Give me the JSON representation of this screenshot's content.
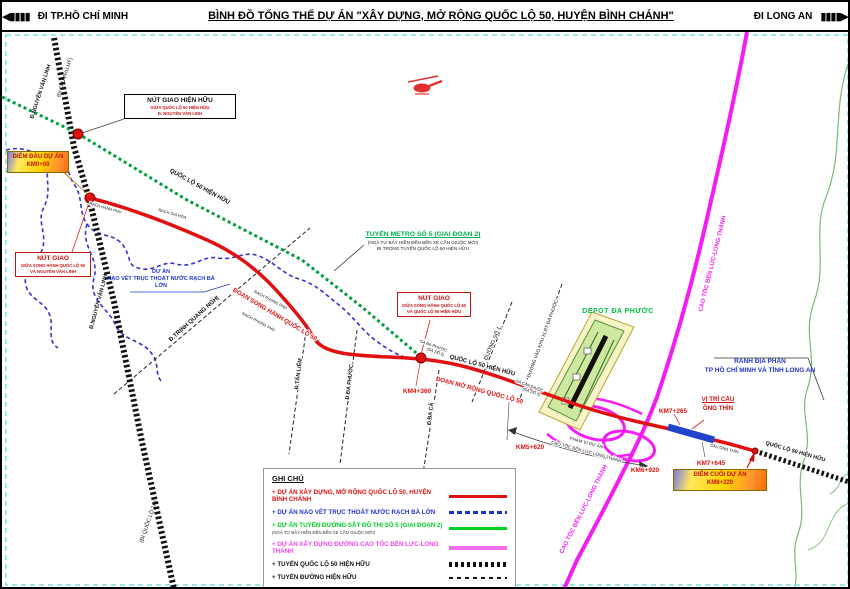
{
  "header": {
    "left_destination": "ĐI TP.HỒ CHÍ MINH",
    "title": "BÌNH ĐỒ TỔNG THỂ DỰ ÁN \"XÂY DỰNG, MỞ RỘNG QUỐC LỘ 50, HUYỆN BÌNH CHÁNH\"",
    "right_destination": "ĐI LONG AN"
  },
  "icons": {
    "arrow_left": "◀",
    "arrow_right": "▶",
    "bars": "▮▮▮▮"
  },
  "colors": {
    "project_red": "#e01010",
    "dredge_blue": "#2233cc",
    "metro_green": "#009f3c",
    "expressway_magenta": "#f31df3",
    "existing_black": "#111111",
    "boundary_green": "#77bb77",
    "callout_yellow": "#ffd400"
  },
  "callouts": {
    "existing_junction": {
      "line1": "NÚT GIAO HIỆN HỮU",
      "line2": "GIỮA QUỐC LỘ 50 HIỆN HỮU",
      "line3": "Đ. NGUYỄN VĂN LINH"
    },
    "start_point": {
      "line1": "ĐIỂM ĐẦU DỰ ÁN",
      "line2": "KM0+00"
    },
    "junction_left": {
      "line1": "NÚT GIAO",
      "line2": "GIỮA SONG HÀNH QUỐC LỘ 50",
      "line3": "VÀ NGUYỄN VĂN LINH"
    },
    "junction_mid": {
      "line1": "NÚT GIAO",
      "line2": "GIỮA SONG HÀNH QUỐC LỘ 50",
      "line3": "VÀ QUỐC LỘ 50 HIỆN HỮU"
    },
    "metro": {
      "line1": "TUYẾN METRO SỐ 5 (GIAI ĐOẠN 2)",
      "line2": "(NGÃ TƯ BẢY HIỀN ĐẾN BẾN XE CẦN GIUỘC MỚI)",
      "line3": "ĐI TRONG TUYẾN QUỐC LỘ 50 HIỆN HỮU"
    },
    "dredge_project": {
      "line1": "DỰ ÁN",
      "line2": "NẠO VÉT TRỤC THOÁT NƯỚC RẠCH BÀ LỚN"
    },
    "depot": "DEPOT ĐA PHƯỚC",
    "boundary": {
      "line1": "RANH ĐỊA PHẬN",
      "line2": "TP HỒ CHÍ MINH VÀ TỈNH LONG AN"
    },
    "bridge_position": {
      "line1": "VỊ TRÍ CẦU",
      "line2": "ÔNG THÌN"
    },
    "end_point": {
      "line1": "ĐIỂM CUỐI DỰ ÁN",
      "line2": "KM8+220"
    },
    "expressway_scope": {
      "line1": "PHẠM VI DỰ ÁN",
      "line2": "CAO TỐC BẾN LỨC LONG THÀNH"
    }
  },
  "km_markers": {
    "km4": "KM4+360",
    "km5": "KM5+620",
    "km6": "KM6+920",
    "km7a": "KM7+265",
    "km7b": "KM7+645"
  },
  "road_labels": {
    "nvl_top": "Đ.NGUYỄN VĂN LINH",
    "nvl_dir_top": "(ĐI CẦU PHÚ MỸ)",
    "nvl_mid": "Đ.NGUYỄN VĂN LINH",
    "nvl_dir_bottom": "(ĐI QUỐC LỘ 1A)",
    "ql50_existing_top": "QUỐC LỘ 50 HIỆN HỮU",
    "ql50_existing_mid": "QUỐC LỘ 50 HIỆN HỮU",
    "ql50_existing_right": "QUỐC LỘ 50 HIỆN HỮU",
    "parallel_section": "ĐOẠN SONG HÀNH QUỐC LỘ 50",
    "widening_section": "ĐOẠN MỞ RỘNG QUỐC LỘ 50",
    "trinh_quang_nghi": "Đ.TRỊNH QUANG NGHỊ",
    "tan_liem": "Đ.TÂN LIÊM",
    "da_phuoc_road": "Đ.ĐA PHƯỚC",
    "ba_ca": "Đ.BA CẢ",
    "duong_so_1": "ĐƯỜNG SỐ 1",
    "waste_road": "ĐƯỜNG VÀO KHU XLRT ĐA PHƯỚC",
    "expressway_top": "CAO TỐC BẾN LỨC-LONG THÀNH",
    "expressway_bottom": "CAO TỐC BẾN LỨC-LONG THÀNH",
    "stream1": "RẠCH HANH PHÚ",
    "stream2": "RẠCH GIA HÒA",
    "stream3": "RẠCH PHONG PHÚ",
    "stream4": "RẠCH PHONG PHÚ",
    "station2a": "GA ĐA PHƯỚC",
    "station2b": "(GA SỐ 2)",
    "station3a": "GA CẦN GIUỘC",
    "station3b": "(GA SỐ 3)",
    "bridge_name": "CẦU ÔNG THÌN"
  },
  "legend": {
    "title": "GHI CHÚ",
    "items": [
      {
        "label": "+ DỰ ÁN XÂY DỰNG, MỞ RỘNG QUỐC LỘ 50, HUYỆN BÌNH CHÁNH"
      },
      {
        "label": "+ DỰ ÁN NẠO VÉT TRỤC THOÁT NƯỚC RẠCH BÀ LỚN"
      },
      {
        "label": "+ DỰ ÁN TUYẾN ĐƯỜNG SẮT ĐÔ THỊ SỐ 5 (GIAI ĐOẠN 2)",
        "sub": "(NGÃ TƯ BẢY HIỀN ĐẾN BẾN XE CẦN GIUỘC MỚI)"
      },
      {
        "label": "+ DỰ ÁN XÂY DỰNG ĐƯỜNG CAO TỐC BẾN LỨC-LONG THÀNH"
      },
      {
        "label": "+ TUYẾN QUỐC LỘ 50 HIỆN HỮU"
      },
      {
        "label": "+ TUYẾN ĐƯỜNG HIỆN HỮU"
      }
    ]
  }
}
